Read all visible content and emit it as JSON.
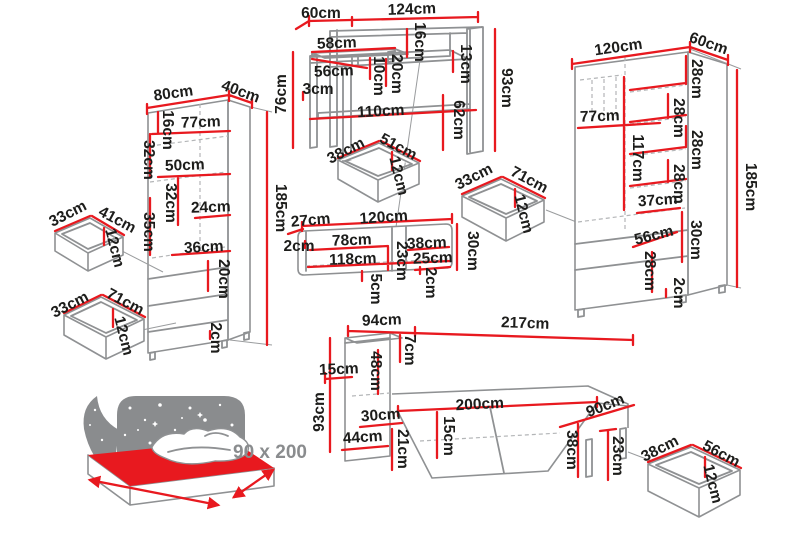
{
  "colors": {
    "dimension_red": "#e8191f",
    "furniture_gray": "#8f9193",
    "label_text": "#1d1d1b",
    "icon_gray": "#8a8c8e",
    "background": "#ffffff"
  },
  "labels": {
    "wardrobe_l": {
      "width": "80cm",
      "depth": "40cm",
      "top_gap": "16cm",
      "inner_width": "77cm",
      "upper_section": "32cm",
      "shelf_width": "50cm",
      "mid_section": "32cm",
      "shelf_gap": "24cm",
      "lower_section": "35cm",
      "drawer_width": "36cm",
      "drawer_height": "20cm",
      "base": "2cm",
      "height": "185cm"
    },
    "drawer_a": {
      "depth": "33cm",
      "width": "41cm",
      "height": "12cm"
    },
    "drawer_b": {
      "depth": "33cm",
      "width": "71cm",
      "height": "12cm"
    },
    "desk": {
      "depth": "60cm",
      "width": "124cm",
      "gap_top": "16cm",
      "gap_right": "13cm",
      "height": "93cm",
      "shelf_width": "58cm",
      "inner_width": "56cm",
      "riser_height": "10cm",
      "gap_mid": "20cm",
      "edge": "3cm",
      "left_height": "76cm",
      "lower_shelf": "110cm",
      "leg_height": "62cm"
    },
    "drawer_c": {
      "depth": "38cm",
      "width": "51cm",
      "height": "12cm"
    },
    "drawer_d": {
      "depth": "33cm",
      "width": "71cm",
      "height": "12cm"
    },
    "shelf": {
      "depth": "27cm",
      "width": "120cm",
      "panel": "2cm",
      "left_compartment": "78cm",
      "right_compartment": "38cm",
      "inner_width": "118cm",
      "inner_height": "25cm",
      "height": "30cm",
      "right_inner_height": "23cm",
      "bottom": "5cm",
      "panel2": "2cm"
    },
    "wardrobe_r": {
      "width": "120cm",
      "depth": "60cm",
      "gap1": "28cm",
      "gap2": "28cm",
      "gap3": "28cm",
      "gap4": "28cm",
      "inner_width": "77cm",
      "inner_height": "117cm",
      "height": "185cm",
      "drawer_width": "37cm",
      "drawer_width2": "56cm",
      "drawer_height": "30cm",
      "drawer_height2": "28cm",
      "base": "2cm"
    },
    "bed": {
      "headboard": "94cm",
      "total_length": "217cm",
      "top": "7cm",
      "headboard_inner": "48cm",
      "gap": "15cm",
      "height": "93cm",
      "shelf1": "30cm",
      "shelf2": "44cm",
      "shelf3": "21cm",
      "drawer_gap": "15cm",
      "length": "200cm",
      "width": "90cm",
      "drawer_height": "38cm",
      "leg": "23cm"
    },
    "drawer_e": {
      "depth": "38cm",
      "width": "56cm",
      "height": "12cm"
    },
    "icon": {
      "size": "90 x 200"
    }
  }
}
